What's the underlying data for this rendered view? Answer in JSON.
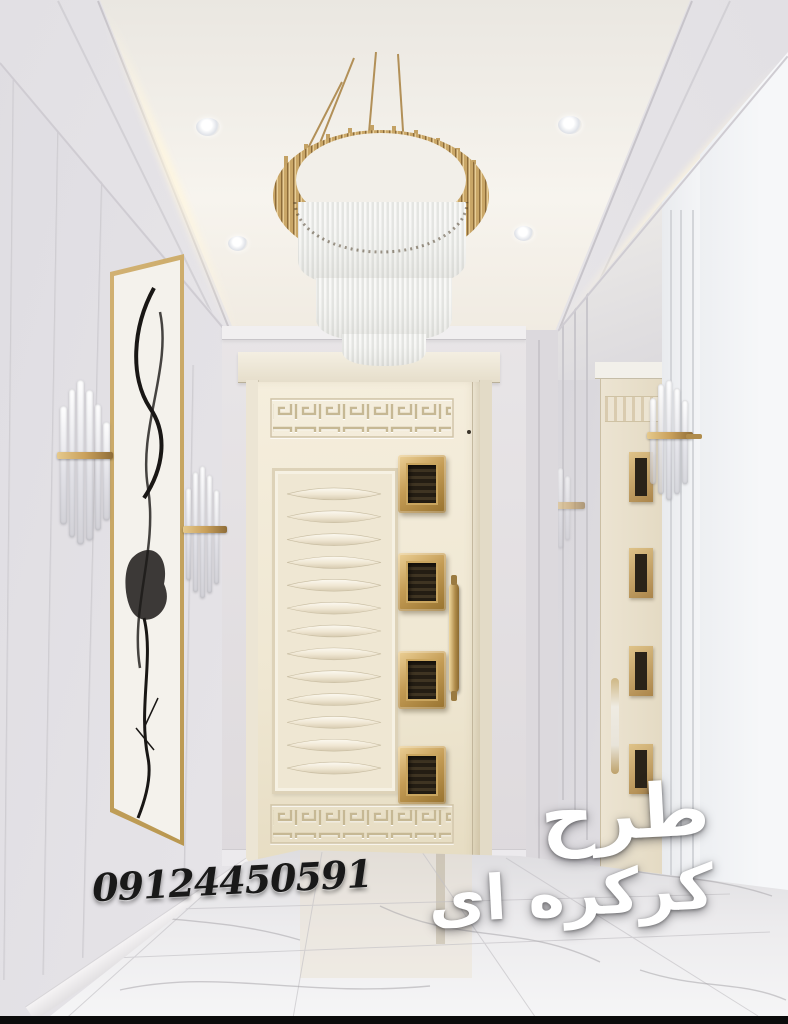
{
  "watermark": {
    "phone_number": "09124450591",
    "caption_line1": "طرح",
    "caption_line2": "کرکره ای"
  },
  "palette": {
    "gold_accent": "#c2a061",
    "door_ivory": "#f0e9d9",
    "wall_grey": "#e6e4e8",
    "ceiling_warm_white": "#f6f3ed",
    "marble_floor": "#ecebed",
    "phone_text_color": "#191919",
    "caption_text_color": "#ffffff"
  }
}
